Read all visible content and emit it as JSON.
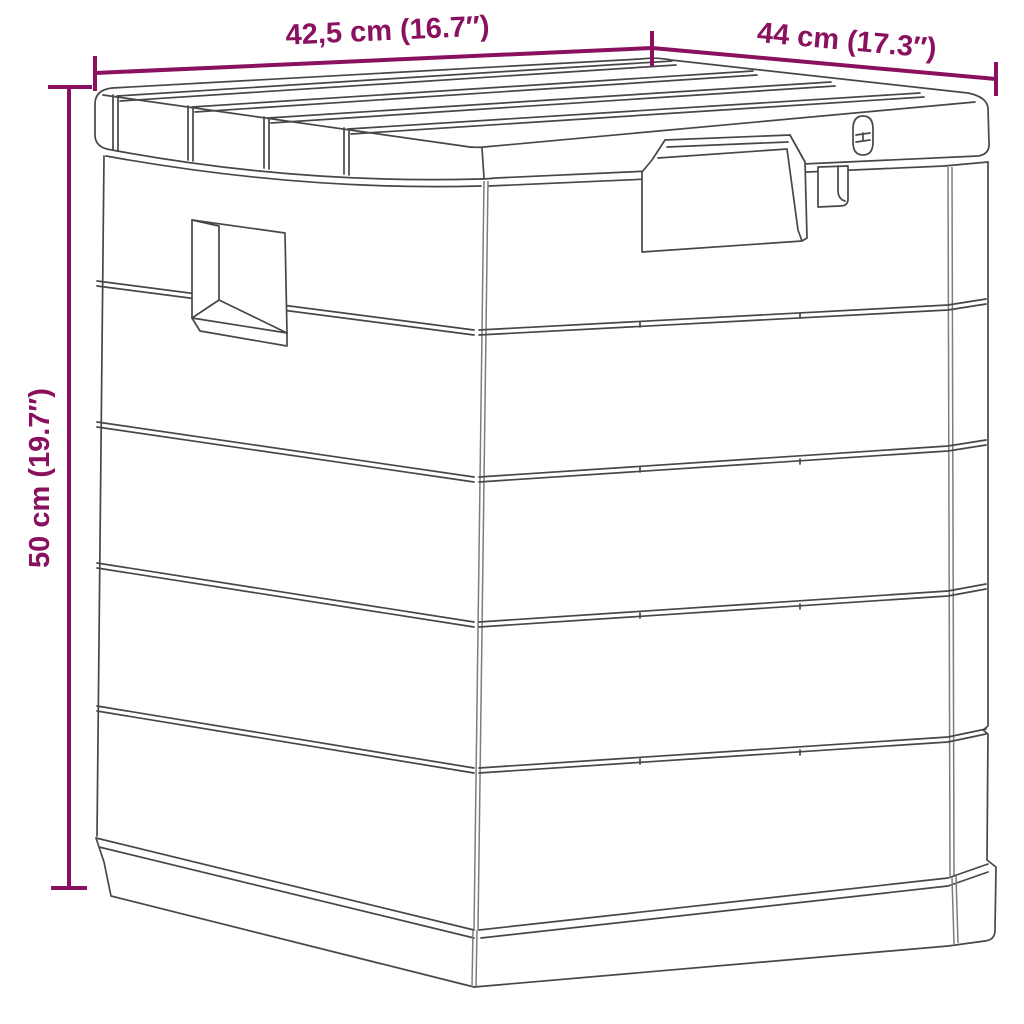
{
  "diagram": {
    "subject": "outdoor storage box line drawing",
    "background": "#ffffff",
    "accent_color": "#8a1060",
    "line_art_color": "#474747",
    "dimensions": {
      "top_width": {
        "label": "42,5 cm (16.7″)",
        "value_cm": "42,5 cm",
        "value_inches": "16.7″"
      },
      "top_depth": {
        "label": "44 cm (17.3″)",
        "value_cm": "44 cm",
        "value_inches": "17.3″"
      },
      "side_height": {
        "label": "50 cm (19.7″)",
        "value_cm": "50 cm",
        "value_inches": "19.7″"
      }
    },
    "drawing_parts": [
      "slatted-lid",
      "lid-latch-recess",
      "padlock-hasp",
      "lock-tab",
      "side-handle-cutout",
      "horizontal-panel-grooves",
      "base-plinth"
    ]
  }
}
